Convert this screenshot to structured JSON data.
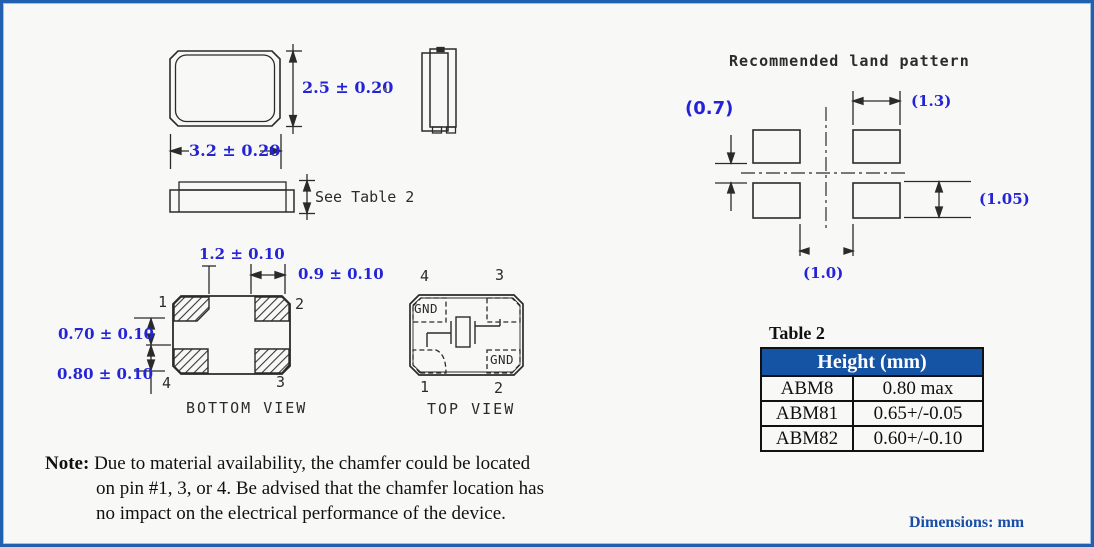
{
  "front_view": {
    "height_dim": "2.5 ± 0.20",
    "width_dim": "3.2 ± 0.20"
  },
  "side_view": {
    "height_dim_label": "See Table 2"
  },
  "bottom_view": {
    "title": "BOTTOM VIEW",
    "dims": {
      "pad_offset": "1.2 ± 0.10",
      "pad_width": "0.9 ± 0.10",
      "pad_gap": "0.70 ± 0.10",
      "pad_height": "0.80 ± 0.10"
    },
    "pins": {
      "top_left": "1",
      "top_right": "2",
      "bottom_left": "4",
      "bottom_right": "3"
    }
  },
  "top_view": {
    "title": "TOP VIEW",
    "pins": {
      "top_left": "4",
      "top_right": "3",
      "bottom_left": "1",
      "bottom_right": "2"
    },
    "gnd_top_left": "GND",
    "gnd_bottom_right": "GND"
  },
  "land_pattern": {
    "title": "Recommended land pattern",
    "dims": {
      "pad_gap_vertical": "(0.7)",
      "pad_width": "(1.3)",
      "pad_height": "(1.05)",
      "pad_gap_horizontal": "(1.0)"
    }
  },
  "table2": {
    "title": "Table 2",
    "header": "Height (mm)",
    "rows": [
      {
        "model": "ABM8",
        "height": "0.80 max"
      },
      {
        "model": "ABM81",
        "height": "0.65+/-0.05"
      },
      {
        "model": "ABM82",
        "height": "0.60+/-0.10"
      }
    ]
  },
  "note": {
    "label": "Note:",
    "lines": [
      "Due to material availability, the chamfer could be located",
      "on pin #1, 3, or 4. Be advised that the chamfer location has",
      "no impact on the electrical performance of the device."
    ]
  },
  "footer": {
    "dimensions_label": "Dimensions: mm"
  },
  "colors": {
    "dim_blue": "#2424d6",
    "table_header_bg": "#1553a4",
    "footer_blue": "#1a4fa5",
    "line": "#2b2b2b",
    "border_blue": "#2060ae"
  }
}
